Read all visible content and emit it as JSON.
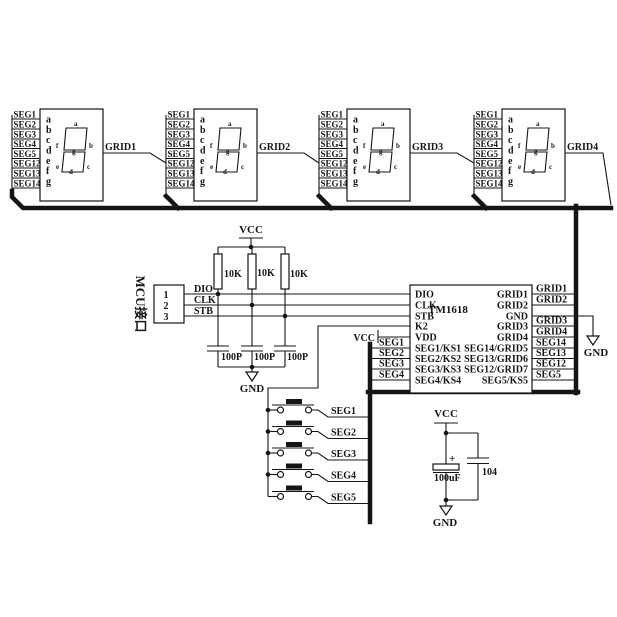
{
  "display": {
    "seg_labels": [
      "SEG1",
      "SEG2",
      "SEG3",
      "SEG4",
      "SEG5",
      "SEG12",
      "SEG13",
      "SEG14"
    ],
    "pin_letters": [
      "a",
      "b",
      "c",
      "d",
      "e",
      "f",
      "g"
    ],
    "segment_letters": [
      "a",
      "f",
      "b",
      "g",
      "e",
      "c",
      "d"
    ],
    "grid_labels": [
      "GRID1",
      "GRID2",
      "GRID3",
      "GRID4"
    ]
  },
  "mcu": {
    "label": "MCU接口",
    "pin_numbers": [
      "1",
      "2",
      "3"
    ],
    "signal_labels": [
      "DIO",
      "CLK",
      "STB"
    ]
  },
  "pullup_resistors": {
    "labels": [
      "10K",
      "10K",
      "10K"
    ]
  },
  "filter_capacitors": {
    "labels": [
      "100P",
      "100P",
      "100P"
    ]
  },
  "power": {
    "vcc": "VCC",
    "gnd": "GND"
  },
  "chip": {
    "name": "TM1618",
    "left_pins": [
      "DIO",
      "CLK",
      "STB",
      "K2",
      "VDD",
      "SEG1/KS1",
      "SEG2/KS2",
      "SEG3/KS3",
      "SEG4/KS4"
    ],
    "right_pins": [
      "GRID1",
      "GRID2",
      "GND",
      "GRID3",
      "GRID4",
      "SEG14/GRID5",
      "SEG13/GRID6",
      "SEG12/GRID7",
      "SEG5/KS5"
    ],
    "right_wire_labels": [
      "GRID1",
      "GRID2",
      "GRID3",
      "GRID4",
      "SEG14",
      "SEG13",
      "SEG12",
      "SEG5"
    ],
    "left_wire_labels": [
      "SEG1",
      "SEG2",
      "SEG3",
      "SEG4"
    ]
  },
  "buttons": {
    "labels": [
      "SEG1",
      "SEG2",
      "SEG3",
      "SEG4",
      "SEG5"
    ]
  },
  "power_caps": {
    "plus_sign": "+",
    "electrolytic_value": "100uF",
    "ceramic_value": "104"
  }
}
